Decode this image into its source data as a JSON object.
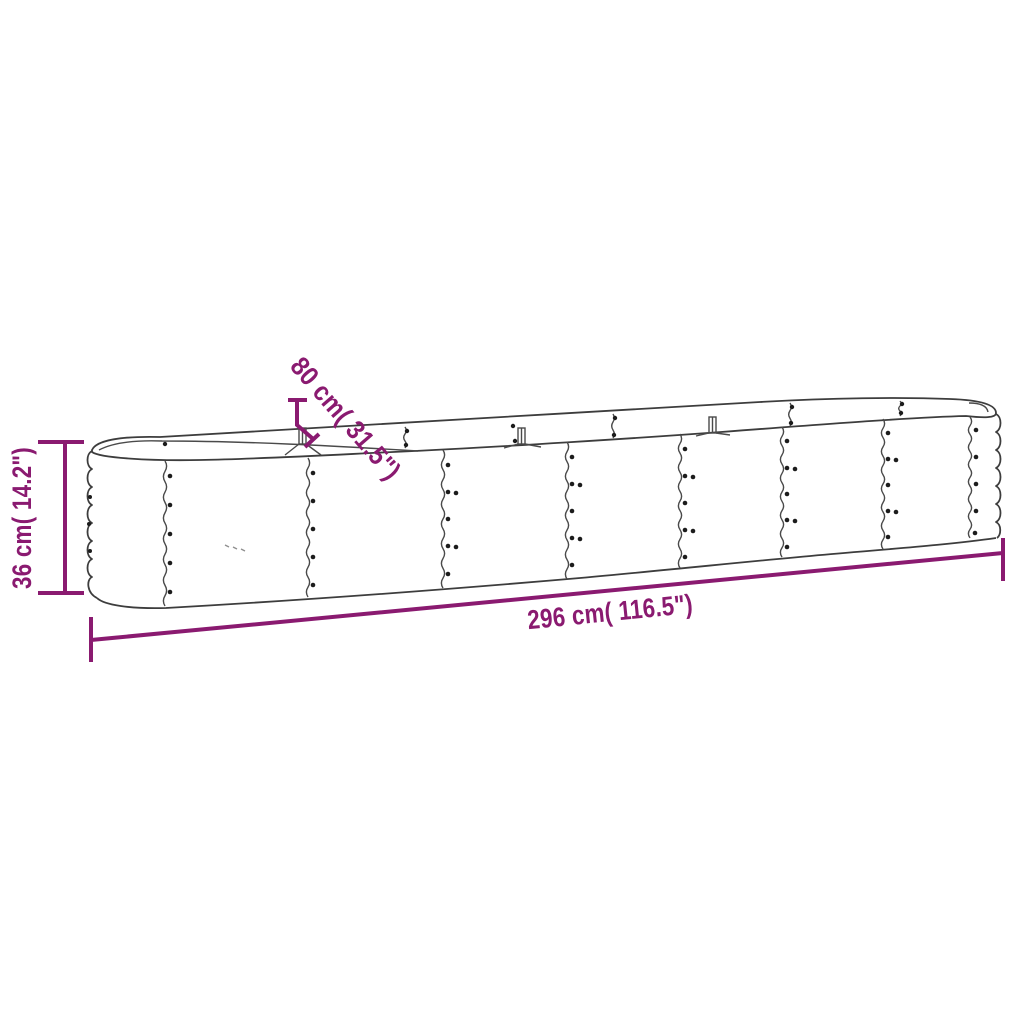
{
  "canvas": {
    "background": "#ffffff",
    "outline_color": "#3d3d3d",
    "accent_color": "#8A1A70"
  },
  "diagram": {
    "kind": "product-dimension-drawing",
    "dimensions": {
      "height": {
        "label": "36 cm( 14.2\")",
        "cm": "36",
        "inches": "14.2"
      },
      "width": {
        "label": "80 cm( 31.5\")",
        "cm": "80",
        "inches": "31.5"
      },
      "length": {
        "label": "296 cm( 116.5\")",
        "cm": "296",
        "inches": "116.5"
      }
    }
  }
}
